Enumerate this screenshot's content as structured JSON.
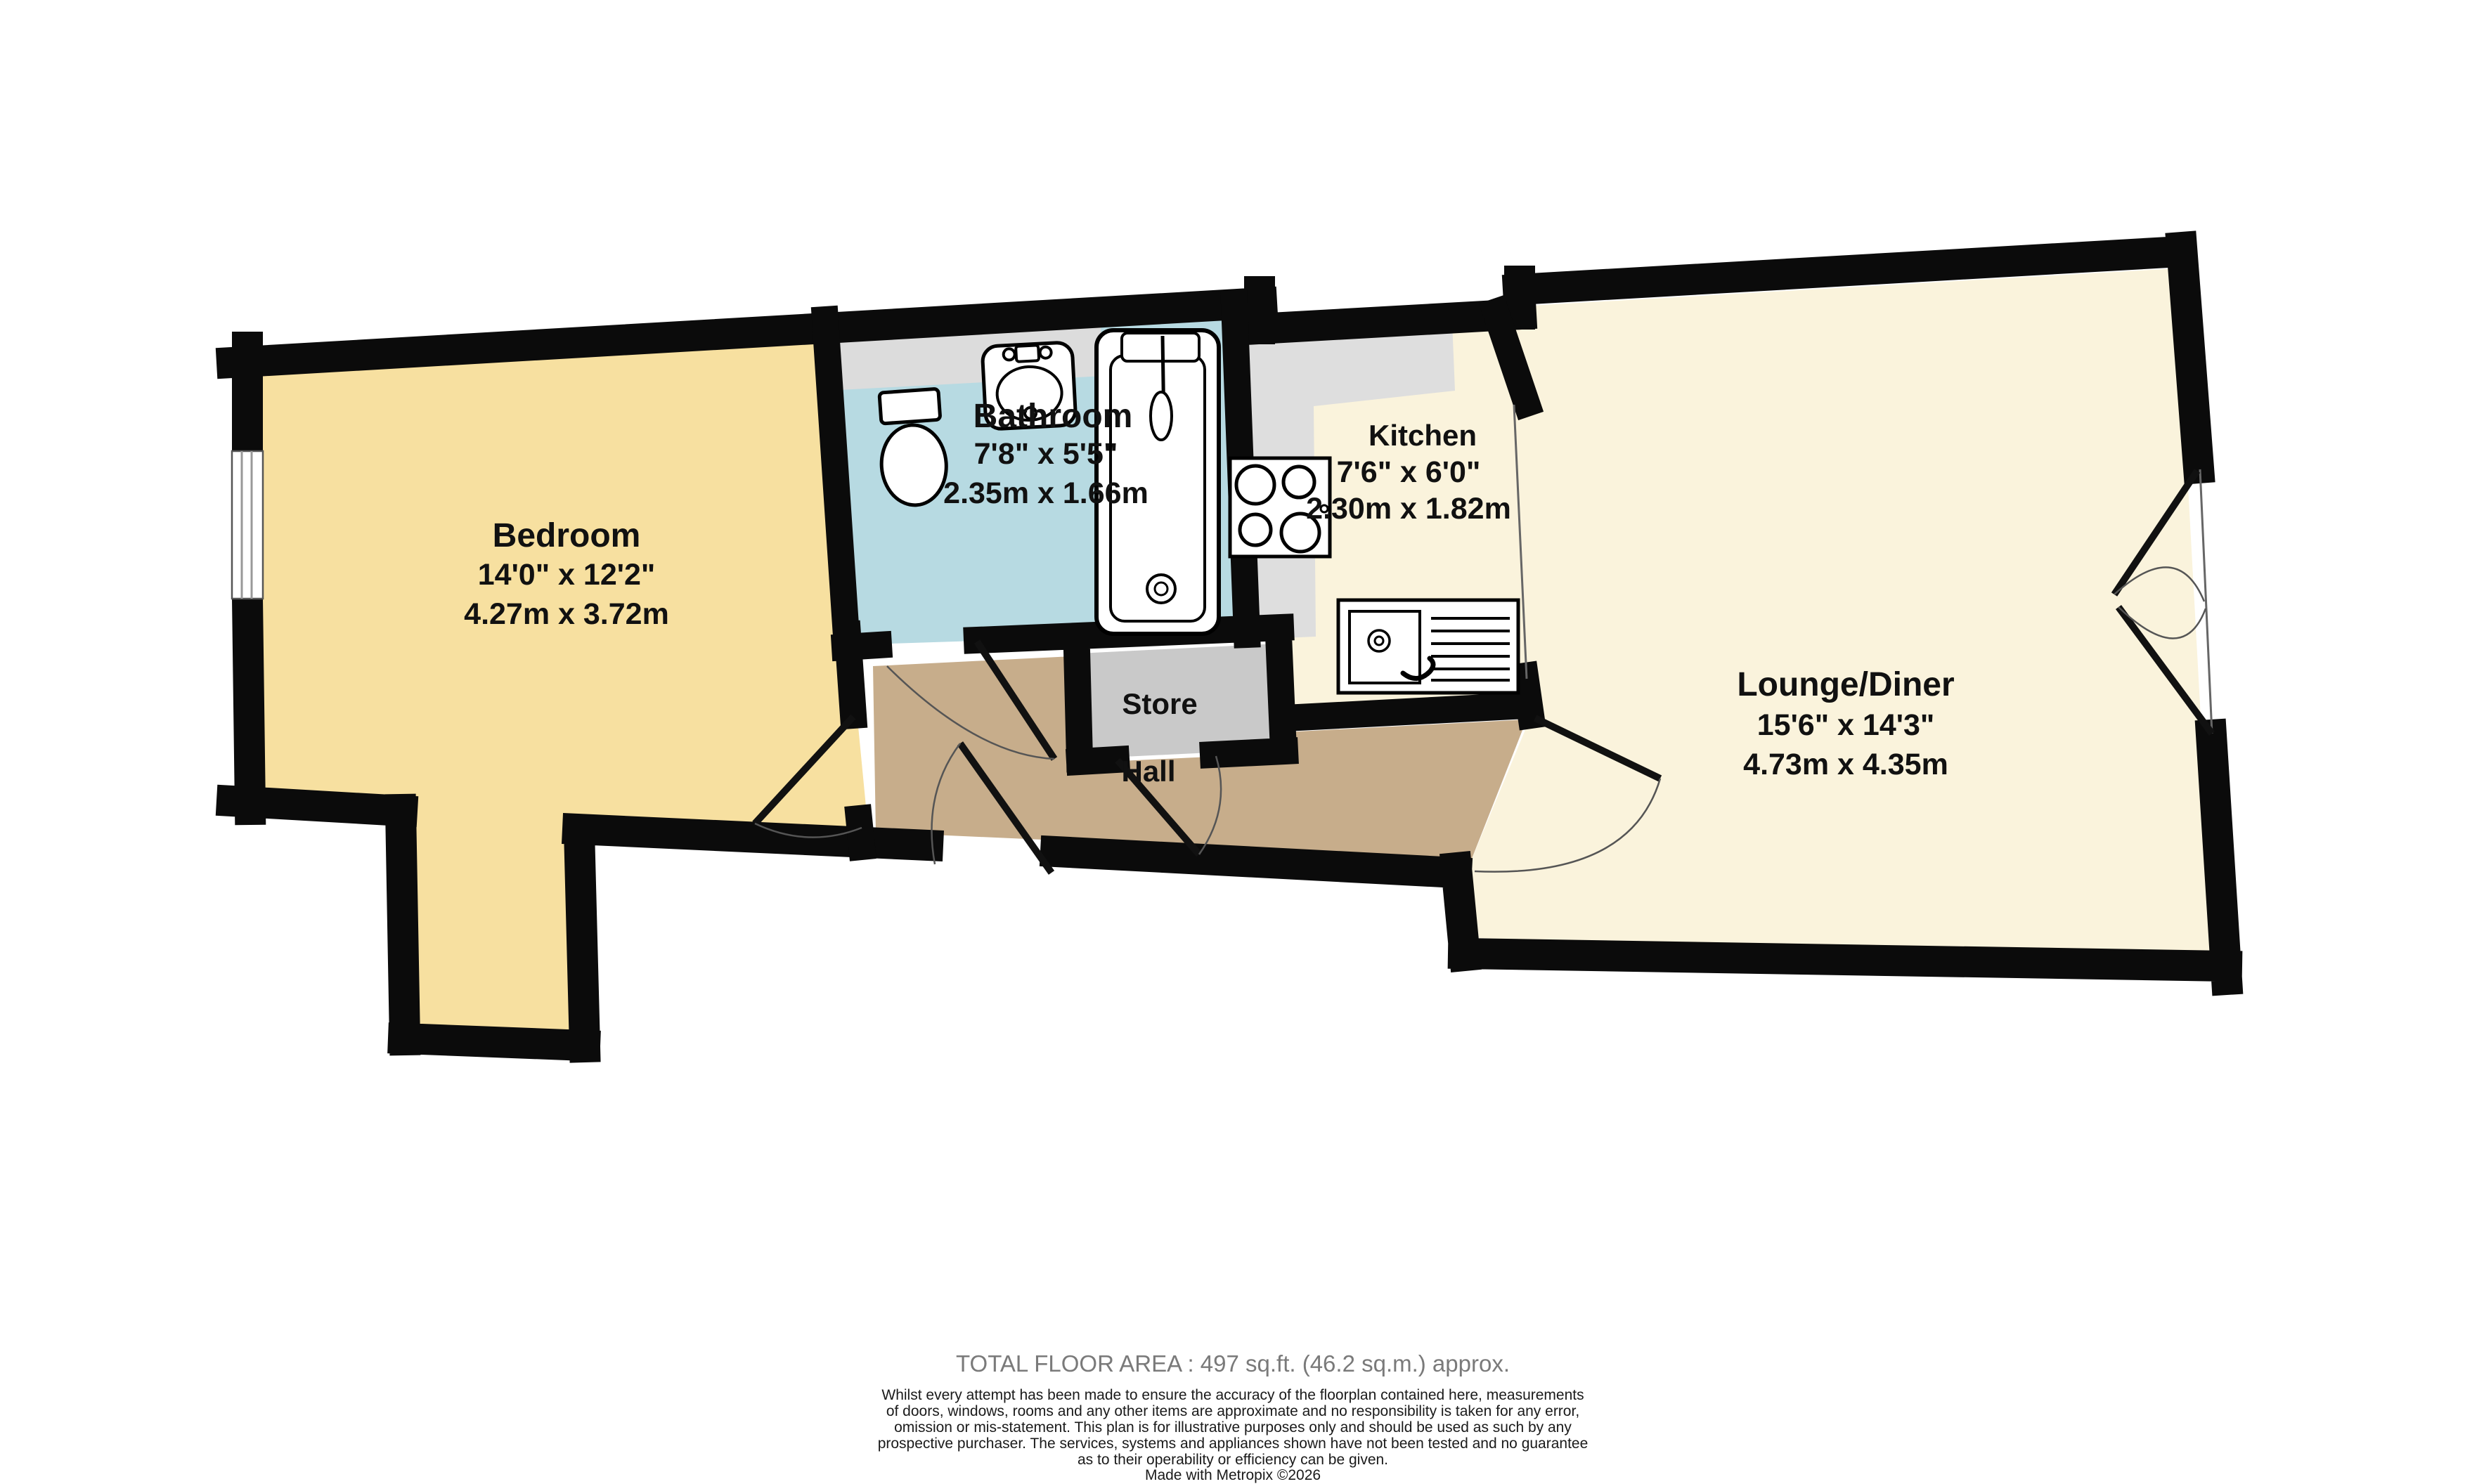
{
  "plan": {
    "colors": {
      "wall": "#0b0b0b",
      "bedroom": "#F7E0A0",
      "bathroom": "#B7DAE2",
      "bathroom_counter": "#DCDCDC",
      "kitchen_floor": "#FAF3DC",
      "kitchen_counter": "#DEDEDE",
      "store": "#C9C9C9",
      "hall": "#C7AD8B",
      "lounge": "#FAF3DC"
    },
    "rooms": [
      {
        "name": "Bedroom",
        "imperial": "14'0\"  x 12'2\"",
        "metric": "4.27m  x 3.72m"
      },
      {
        "name": "Bathroom",
        "imperial": "7'8\"  x 5'5\"",
        "metric": "2.35m  x 1.66m"
      },
      {
        "name": "Kitchen",
        "imperial": "7'6\"  x 6'0\"",
        "metric": "2.30m  x 1.82m"
      },
      {
        "name": "Store"
      },
      {
        "name": "Hall"
      },
      {
        "name": "Lounge/Diner",
        "imperial": "15'6\"  x 14'3\"",
        "metric": "4.73m  x 4.35m"
      }
    ],
    "fixtures": [
      "toilet-icon",
      "bathroom-sink-icon",
      "bathtub-icon",
      "hob-icon",
      "kitchen-sink-icon",
      "window-icon",
      "door-swing-icon"
    ]
  },
  "footer": {
    "total_area": "TOTAL FLOOR AREA : 497 sq.ft. (46.2 sq.m.) approx.",
    "disclaimer_lines": [
      "Whilst every attempt has been made to ensure the accuracy of the floorplan contained here, measurements",
      "of doors, windows, rooms and any other items are approximate and no responsibility is taken for any error,",
      "omission or mis-statement. This plan is for illustrative purposes only and should be used as such by any",
      "prospective purchaser. The services, systems and appliances shown have not been tested and no guarantee",
      "as to their operability or efficiency can be given.",
      "Made with Metropix ©2026"
    ]
  }
}
